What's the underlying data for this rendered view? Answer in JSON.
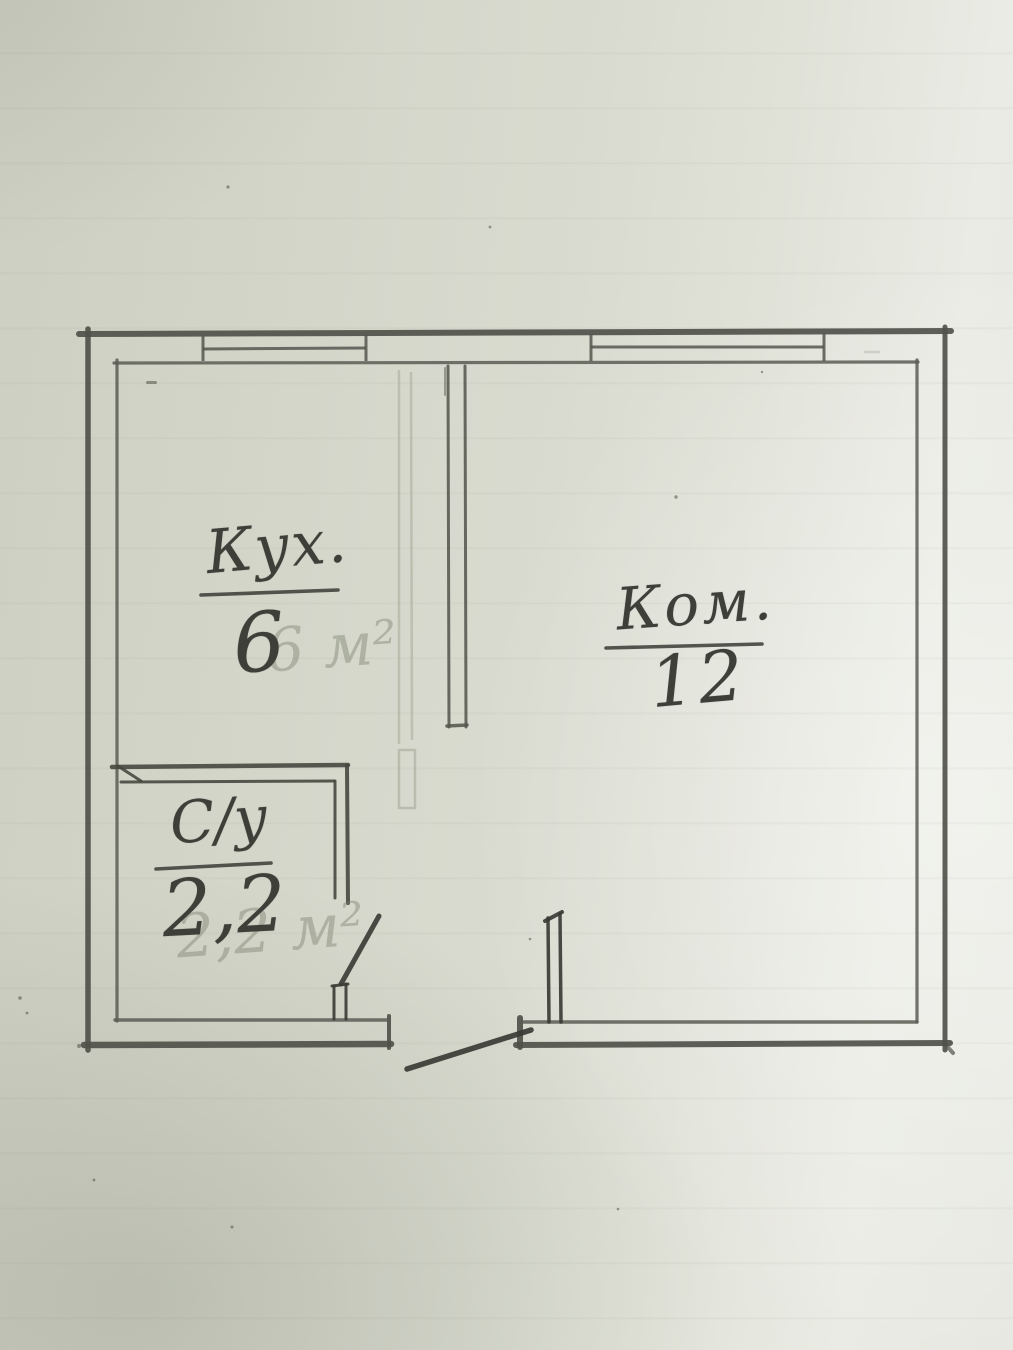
{
  "plan": {
    "description": "Hand-drawn apartment floor plan, pencil on scanned paper",
    "rooms": {
      "kitchen": {
        "label": "Кух.",
        "area": "6",
        "ghost": "6 м²"
      },
      "living": {
        "label": "Ком.",
        "area": "12"
      },
      "bathroom": {
        "label": "С/у",
        "area": "2,2",
        "ghost": "2,2 м²"
      }
    },
    "colors": {
      "paper": "#d7d9ce",
      "paper_light": "#ecede7",
      "graphite": "#4a4b44",
      "pencil_faint": "#a3a698"
    }
  }
}
